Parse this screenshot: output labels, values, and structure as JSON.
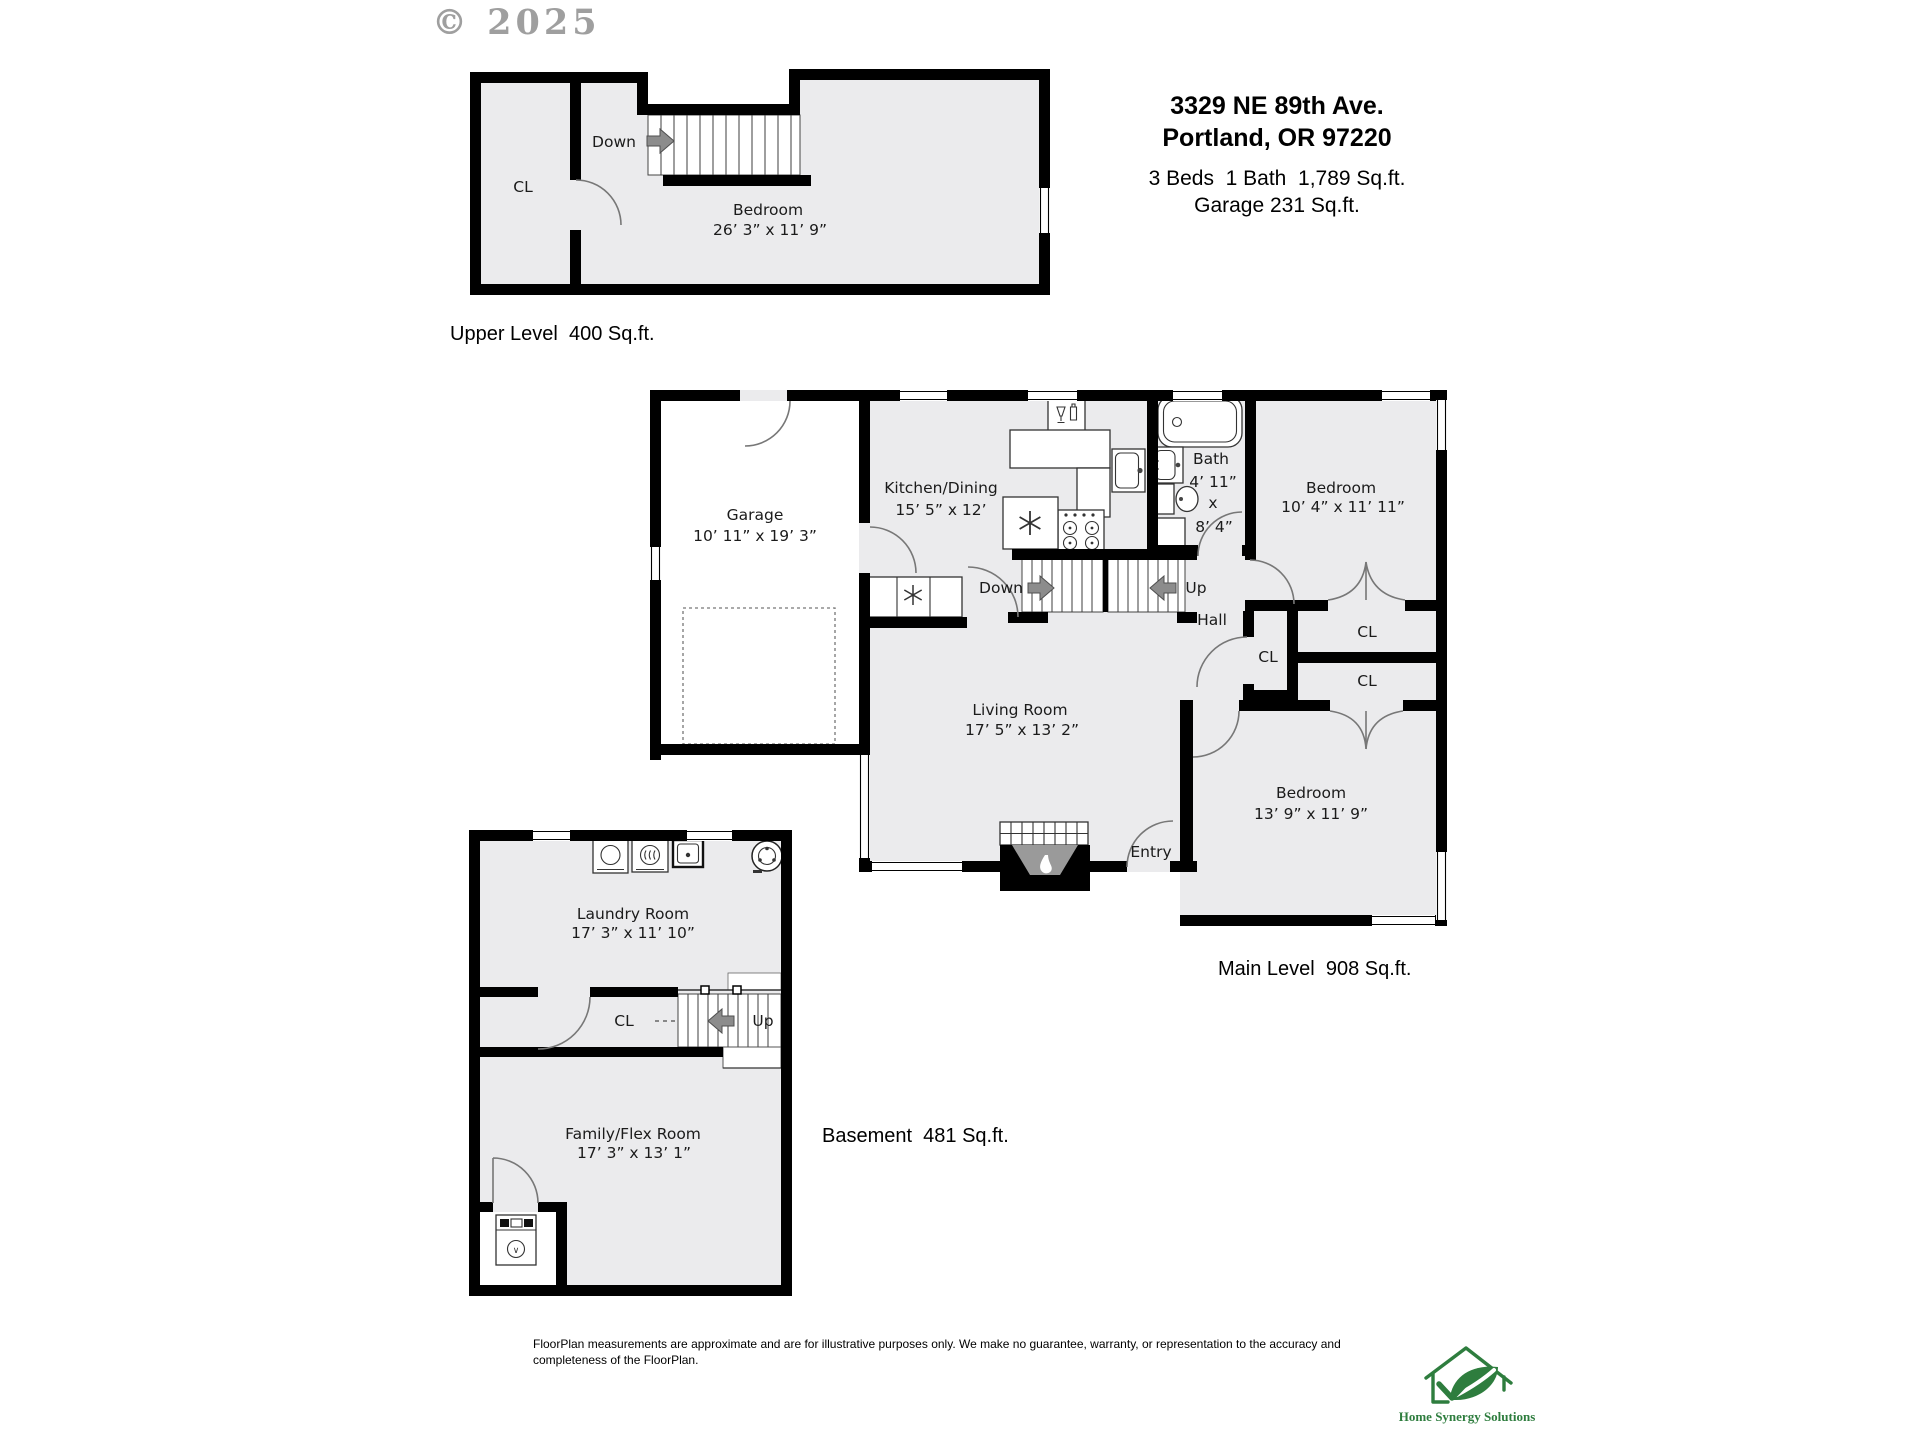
{
  "watermark": {
    "text": "© 2025"
  },
  "address": {
    "line1": "3329 NE 89th Ave.",
    "line2": "Portland, OR 97220",
    "stats": "3 Beds  1 Bath  1,789 Sq.ft.",
    "garage": "Garage 231 Sq.ft."
  },
  "upper": {
    "caption": "Upper Level  400 Sq.ft.",
    "cl": "CL",
    "down": "Down",
    "bedroom": "Bedroom",
    "bedroom_dims": "26’ 3” x 11’ 9”"
  },
  "main": {
    "caption": "Main Level  908 Sq.ft.",
    "garage": "Garage",
    "garage_dims": "10’ 11” x 19’ 3”",
    "kitchen": "Kitchen/Dining",
    "kitchen_dims": "15’ 5” x 12’",
    "bath": "Bath",
    "bath_w": "4’ 11”",
    "bath_x": "x",
    "bath_h": "8’ 4”",
    "bedroom_tr": "Bedroom",
    "bedroom_tr_dims": "10’ 4” x 11’ 11”",
    "down": "Down",
    "up": "Up",
    "hall": "Hall",
    "cl_hall": "CL",
    "cl_top": "CL",
    "cl_bottom": "CL",
    "living": "Living Room",
    "living_dims": "17’ 5” x 13’ 2”",
    "bedroom_br": "Bedroom",
    "bedroom_br_dims": "13’ 9” x 11’ 9”",
    "entry": "Entry"
  },
  "basement": {
    "caption": "Basement  481 Sq.ft.",
    "laundry": "Laundry Room",
    "laundry_dims": "17’ 3” x 11’ 10”",
    "cl": "CL",
    "up": "Up",
    "family": "Family/Flex Room",
    "family_dims": "17’ 3” x 13’ 1”"
  },
  "footer": {
    "disclaimer": "FloorPlan measurements are approximate and are for illustrative purposes only. We make no guarantee, warranty, or representation to the accuracy and completeness of the FloorPlan."
  },
  "logo": {
    "name": "Home Synergy Solutions"
  },
  "colors": {
    "wall": "#000000",
    "room_fill": "#ebebed",
    "accent_green": "#2e7d3e",
    "arrow_gray": "#8c8c8c"
  }
}
